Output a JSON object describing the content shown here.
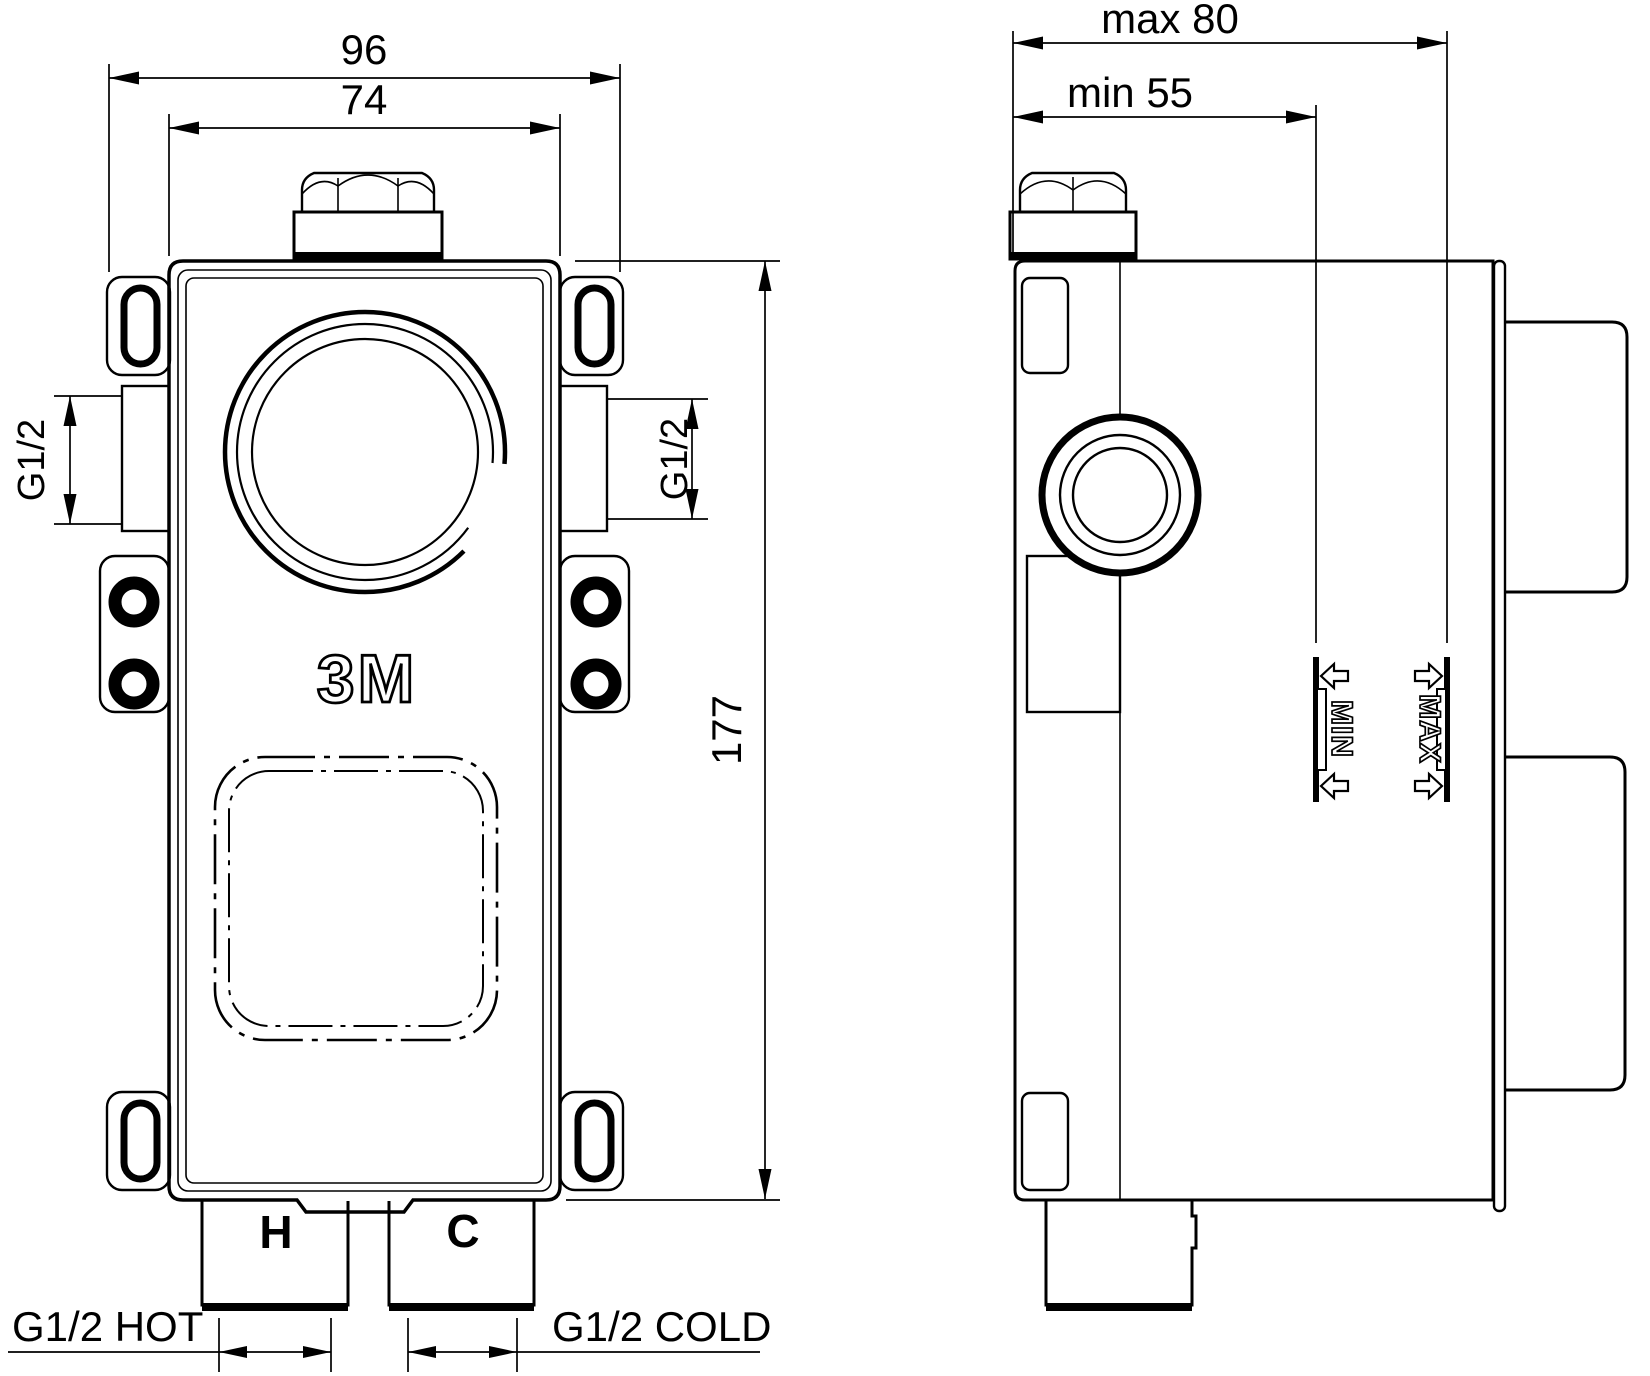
{
  "drawing": {
    "type": "technical-installation-drawing",
    "subject": "concealed mixer valve rough-in body, front and side views",
    "colors": {
      "line": "#000000",
      "background": "#ffffff"
    },
    "front_view": {
      "dim_overall_width": "96",
      "dim_body_width": "74",
      "dim_height": "177",
      "thread_left": "G1/2",
      "thread_right": "G1/2",
      "logo": "3M",
      "hot_mark": "H",
      "cold_mark": "C",
      "hot_connection_label": "G1/2 HOT",
      "cold_connection_label": "G1/2 COLD"
    },
    "side_view": {
      "dim_depth_max": "max  80",
      "dim_depth_min": "min  55",
      "plaster_min_label": "MIN",
      "plaster_max_label": "MAX"
    }
  }
}
